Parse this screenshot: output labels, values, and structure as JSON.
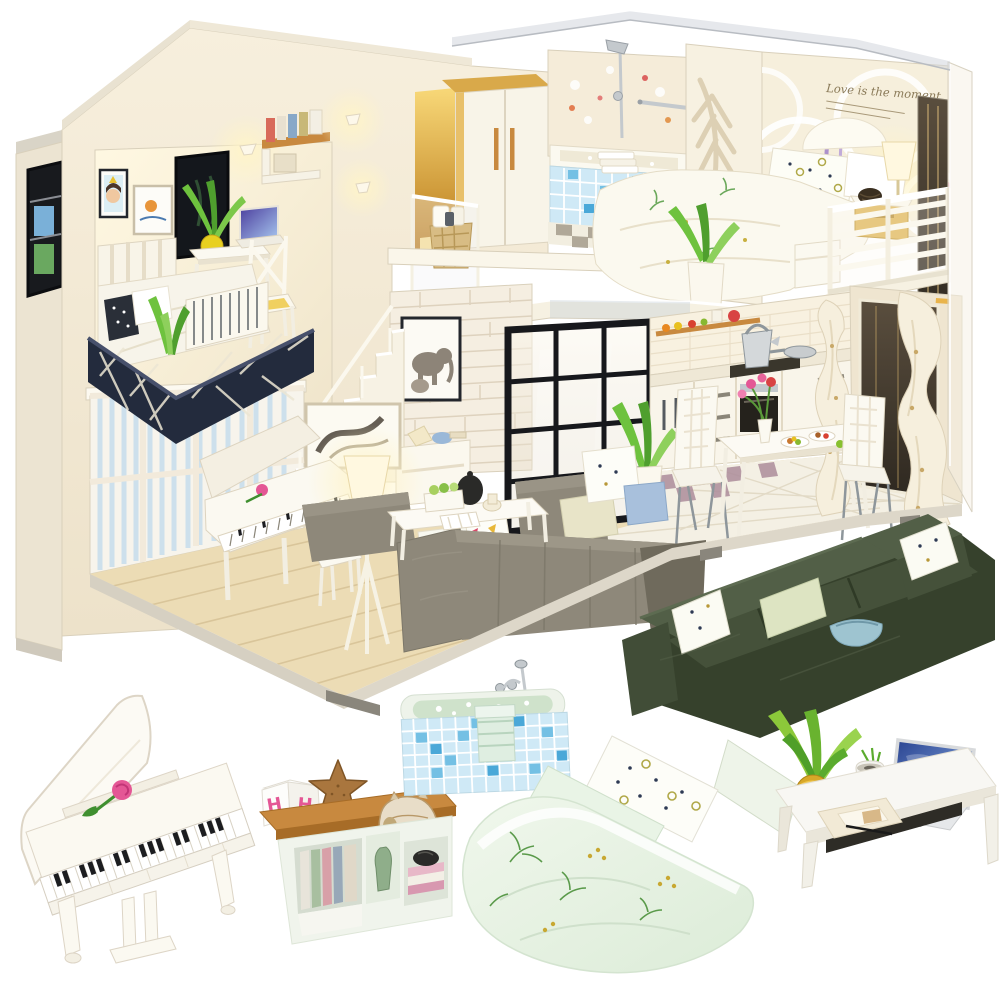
{
  "meta": {
    "type": "product-photo",
    "subject": "DIY miniature dollhouse kit: modern two-story loft cutaway with lit furnished rooms, shown with six standalone miniature furniture pieces on a white background",
    "background": "#ffffff"
  },
  "texts": {
    "wall_quote": "Love is the moment",
    "cube_letter": "H"
  },
  "palette": {
    "bg": "#ffffff",
    "cream": "#f3ead7",
    "creamLit": "#fdf6e4",
    "creamShade": "#e7dcc4",
    "edge": "#d9d0bb",
    "roof": "#d9d4c7",
    "glow": "#ffeebb",
    "wood": "#ecdcb5",
    "woodLine": "#d9c59a",
    "navy": "#232b3d",
    "navyLine": "#47506b",
    "stripe": "#cde0ec",
    "gold": "#e9b44c",
    "goldDeep": "#bf7a1e",
    "mint": "#e7f2e3",
    "mintDeep": "#cfe5d2",
    "mosaic": "#74c0e4",
    "mosaicDeep": "#4aa8d8",
    "mosaicPale": "#cfe9f6",
    "brick": "#f5eee1",
    "brickLine": "#ded2be",
    "checker": "#ab8c9a",
    "tile": "#f4f0e4",
    "tileLine": "#e2dac6",
    "graySofa": "#8e887a",
    "graySofaDark": "#6f6a5c",
    "greenSofa": "#46523c",
    "greenSofaDark": "#36412c",
    "greenSofaLit": "#525f47",
    "leaf": "#7cc245",
    "leafDark": "#47962f",
    "tan": "#c8893f",
    "tanDark": "#a76c27",
    "pink": "#e45795",
    "red": "#d84343",
    "chrome": "#c4c9cd",
    "chromeDark": "#8e969b",
    "dark": "#17181c",
    "paper": "#efe6cf",
    "white": "#fbf9f2",
    "curtain": "#f6efdd",
    "winDark": "#4a4136",
    "yellowPot": "#d8a828"
  },
  "dollhouse": {
    "rooms": [
      {
        "name": "loft-study-bedroom",
        "contents": [
          "framed girl portrait",
          "framed bird art",
          "black wall screen",
          "potted plant in yellow pot",
          "white desk with laptop",
          "cross-back chair with yellow cushion",
          "wall shelf with books",
          "lit wall lamp",
          "white bed with leaf-print duvet",
          "dotted dark pillow",
          "navy lattice balcony railing"
        ]
      },
      {
        "name": "wardrobe-hall",
        "contents": [
          "white wardrobe with gold trim and handles",
          "glowing gold alcove",
          "two lit wall sconces",
          "acrylic stair railing",
          "woven basket with towels"
        ]
      },
      {
        "name": "bathroom",
        "contents": [
          "bathtub with blue mosaic front",
          "folded towels on rim",
          "chrome shower set and towel bar",
          "floral back wall",
          "checkered floor"
        ]
      },
      {
        "name": "master-bedroom",
        "contents": [
          "circle-pattern headboard wall",
          "script wall quote",
          "double bed with floral duvet",
          "patterned pillows",
          "lit table lamp on gold nightstand",
          "dark woven basket",
          "purple wall decor",
          "pink flower doll",
          "white bench",
          "white slat balcony railing",
          "potted plant on loft edge",
          "dark mirror panel",
          "acrylic outer wall"
        ]
      },
      {
        "name": "living-room",
        "contents": [
          "blue striped panel wall",
          "white grand piano with pink rose",
          "white piano stool",
          "lit tripod floor lamp",
          "abstract framed art",
          "gray sectional sofa",
          "white dotted and blue pillows",
          "banner-print pillows",
          "gray ottoman",
          "white coffee table with black teapot, mug, greens and open book",
          "wood plank floor"
        ]
      },
      {
        "name": "stair-hall",
        "contents": [
          "white brick wall",
          "framed elephant print",
          "white staircase",
          "white console with decor",
          "black framed glass partition"
        ]
      },
      {
        "name": "kitchen-dining",
        "contents": [
          "white cabinets and drawers",
          "oven",
          "cooktop with silver kettle and pan",
          "wall shelf with fruit",
          "red pot",
          "checkered kitchen floor",
          "white tile dining floor",
          "dining table with pink tulips and food plates",
          "two white quilted chairs with chrome legs",
          "potted plant",
          "sheer curtains",
          "dark window with gold handle"
        ]
      }
    ]
  },
  "furniture_items": [
    {
      "name": "grand-piano",
      "label": "white grand piano with open lid and pink rose"
    },
    {
      "name": "letter-cube",
      "label": "white cube with pink letter"
    },
    {
      "name": "bookshelf",
      "label": "low bookshelf with wood top, books, green vase, starfish, conch shell and black stone"
    },
    {
      "name": "bathtub",
      "label": "blue mosaic bathtub with chrome faucet and mint towel"
    },
    {
      "name": "bed",
      "label": "bed with mint leaf-print duvet and two pillows"
    },
    {
      "name": "sectional-sofa",
      "label": "dark green corner sofa with dotted pillows, cushion and blue bowl"
    },
    {
      "name": "desk",
      "label": "white desk with laptop, aloe plant in yellow pot, small planter, papers and pen"
    }
  ]
}
